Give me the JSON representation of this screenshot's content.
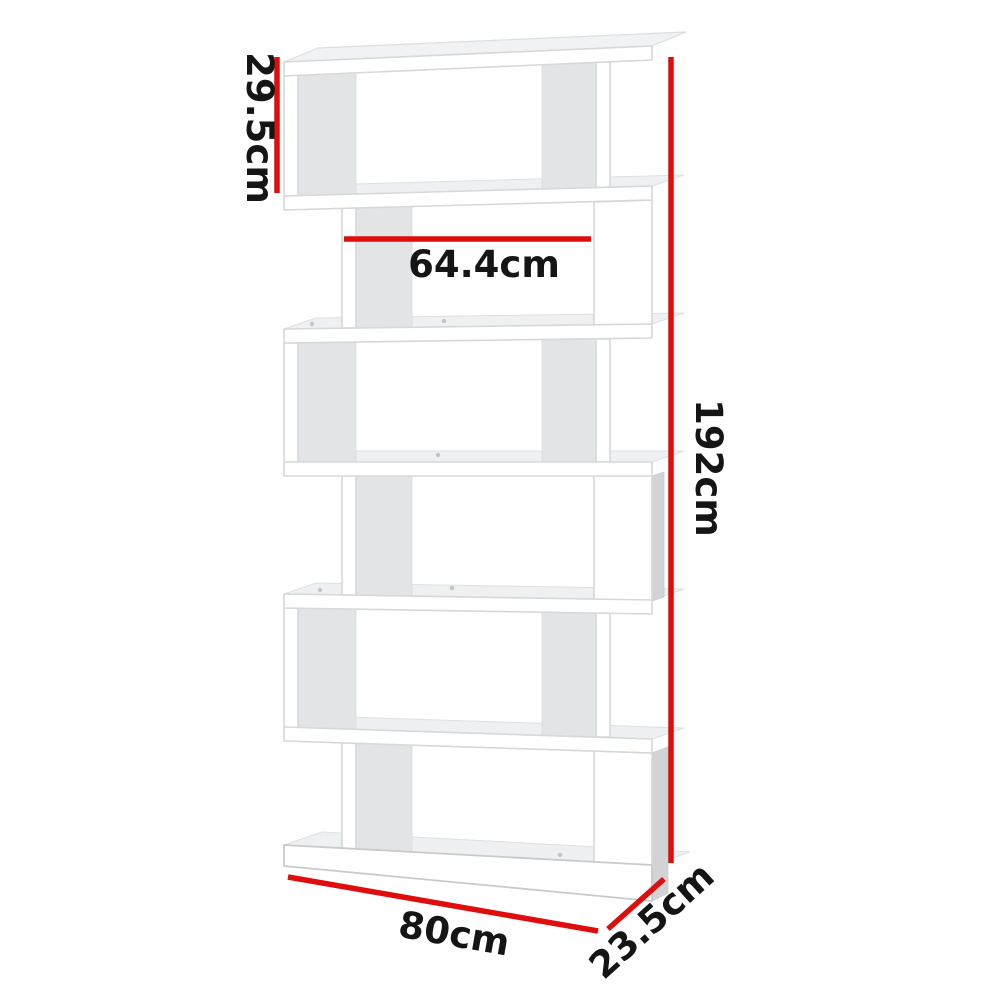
{
  "image": {
    "type": "product-dimension-diagram",
    "subject": "white 6-tier S-shaped zigzag display bookshelf"
  },
  "dimensions": {
    "tier_height": "29.5cm",
    "inner_width": "64.4cm",
    "total_height": "192cm",
    "total_width": "80cm",
    "depth": "23.5cm"
  },
  "colors": {
    "dimension_line": "#e00d0d",
    "label_text": "#151515",
    "shelf_front": "#ffffff",
    "shelf_shade": "#e3e4e6",
    "shelf_side": "#d2d3d5",
    "background": "#ffffff"
  }
}
